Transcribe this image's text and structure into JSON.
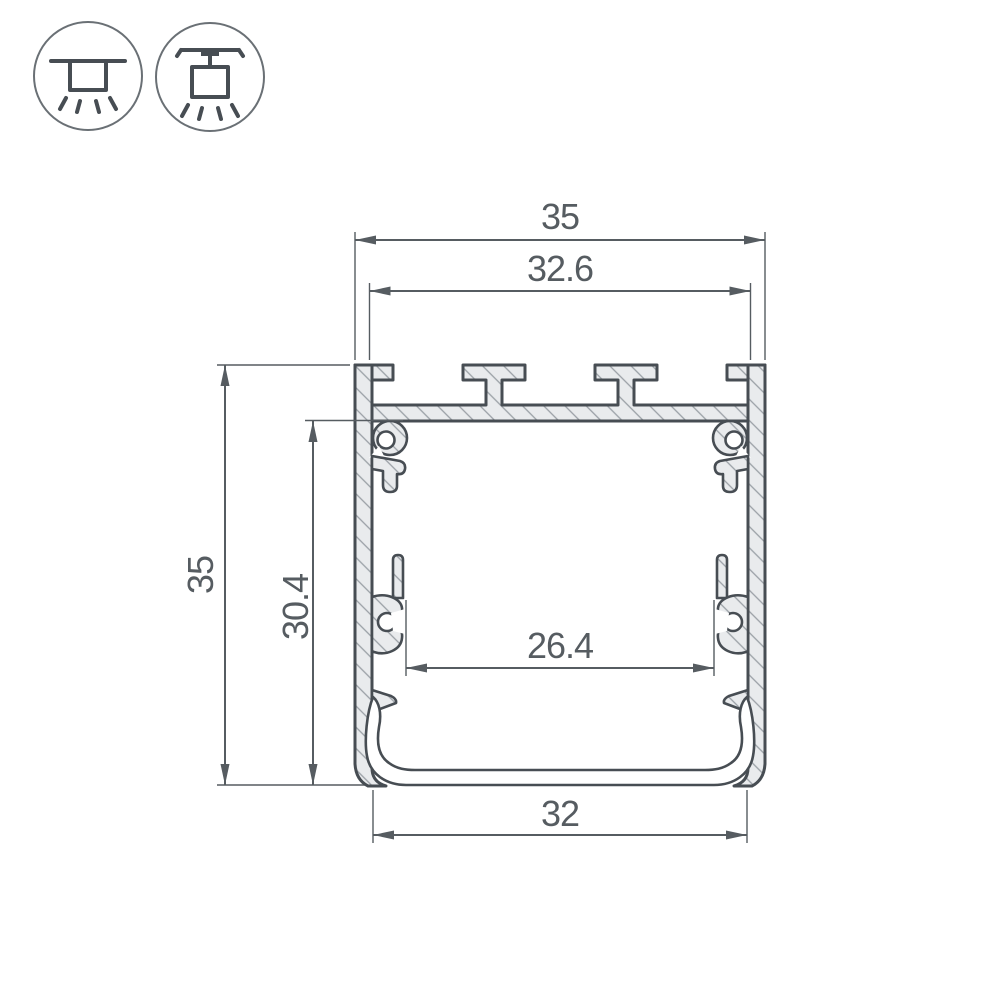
{
  "title": "Aluminium LED profile cross-section drawing",
  "icons": {
    "surface_mount": {
      "name": "surface-mount-luminaire-icon"
    },
    "pendant_mount": {
      "name": "pendant-mount-luminaire-icon"
    }
  },
  "dimensions": {
    "outer_width": "35",
    "inner_top_width": "32.6",
    "outer_height": "35",
    "inner_height": "30.4",
    "inner_width": "26.4",
    "bottom_width": "32"
  },
  "colors": {
    "line": "#474d53",
    "dim": "#565c61",
    "hatch-line": "#9aa0a6",
    "material-fill": "#e9ebed",
    "background": "#ffffff"
  }
}
